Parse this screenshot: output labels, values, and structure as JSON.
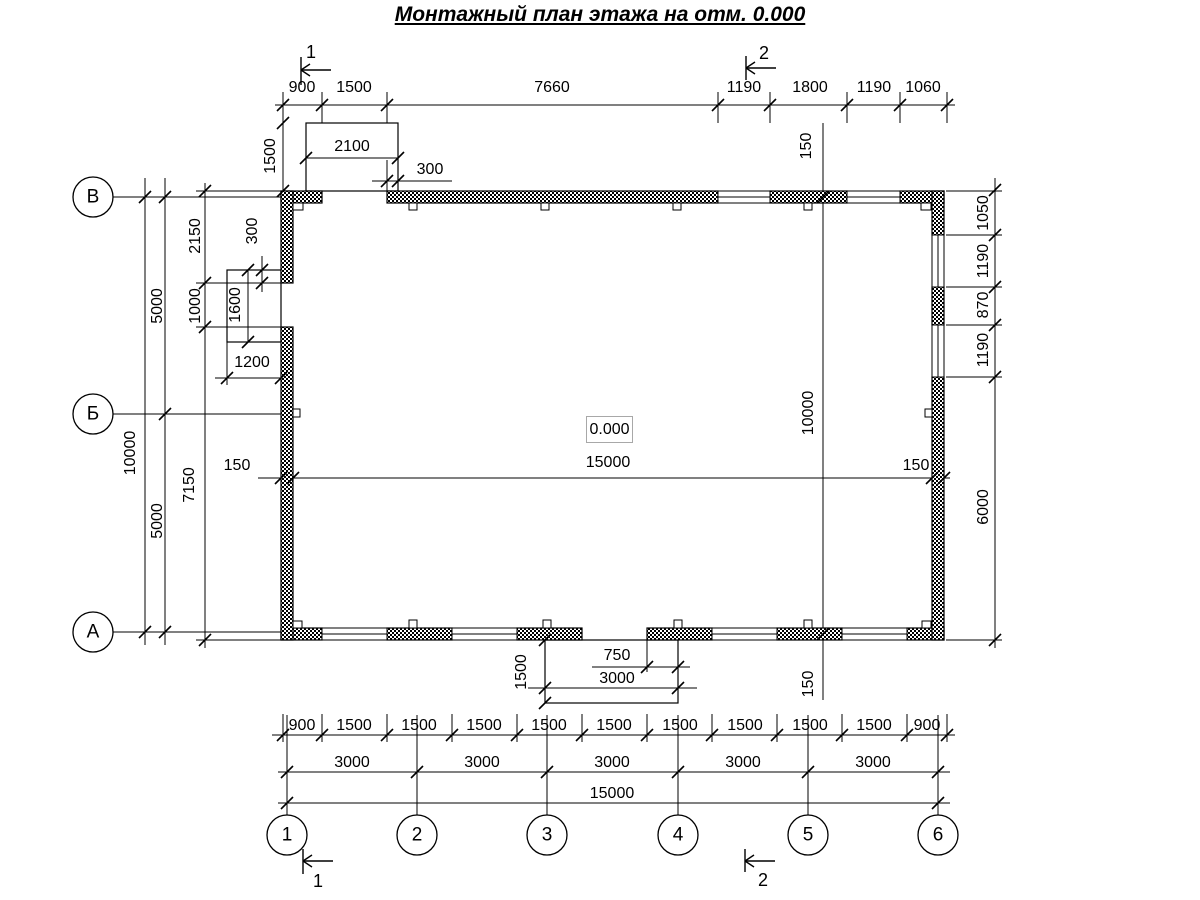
{
  "title": "Монтажный план этажа на отм. 0.000",
  "elevation_label": "0.000",
  "dim_labels": [
    {
      "t": "900",
      "x": 302,
      "y": 88
    },
    {
      "t": "1500",
      "x": 354,
      "y": 88
    },
    {
      "t": "7660",
      "x": 552,
      "y": 88
    },
    {
      "t": "1190",
      "x": 744,
      "y": 88
    },
    {
      "t": "1800",
      "x": 810,
      "y": 88
    },
    {
      "t": "1190",
      "x": 874,
      "y": 88
    },
    {
      "t": "1060",
      "x": 923,
      "y": 88
    },
    {
      "t": "2100",
      "x": 352,
      "y": 147
    },
    {
      "t": "1500",
      "x": 271,
      "y": 156,
      "r": 1
    },
    {
      "t": "300",
      "x": 430,
      "y": 170
    },
    {
      "t": "150",
      "x": 807,
      "y": 146,
      "r": 1
    },
    {
      "t": "300",
      "x": 253,
      "y": 231,
      "r": 1
    },
    {
      "t": "2150",
      "x": 196,
      "y": 236,
      "r": 1
    },
    {
      "t": "1000",
      "x": 196,
      "y": 306,
      "r": 1
    },
    {
      "t": "1600",
      "x": 236,
      "y": 305,
      "r": 1
    },
    {
      "t": "1200",
      "x": 252,
      "y": 363
    },
    {
      "t": "5000",
      "x": 158,
      "y": 306,
      "r": 1
    },
    {
      "t": "5000",
      "x": 158,
      "y": 521,
      "r": 1
    },
    {
      "t": "10000",
      "x": 131,
      "y": 453,
      "r": 1
    },
    {
      "t": "7150",
      "x": 190,
      "y": 485,
      "r": 1
    },
    {
      "t": "1050",
      "x": 984,
      "y": 213,
      "r": 1
    },
    {
      "t": "1190",
      "x": 984,
      "y": 261,
      "r": 1
    },
    {
      "t": "870",
      "x": 984,
      "y": 305,
      "r": 1
    },
    {
      "t": "1190",
      "x": 984,
      "y": 350,
      "r": 1
    },
    {
      "t": "6000",
      "x": 984,
      "y": 507,
      "r": 1
    },
    {
      "t": "10000",
      "x": 809,
      "y": 413,
      "r": 1
    },
    {
      "t": "150",
      "x": 237,
      "y": 466
    },
    {
      "t": "15000",
      "x": 608,
      "y": 463
    },
    {
      "t": "150",
      "x": 916,
      "y": 466
    },
    {
      "t": "1500",
      "x": 522,
      "y": 672,
      "r": 1
    },
    {
      "t": "750",
      "x": 617,
      "y": 656
    },
    {
      "t": "3000",
      "x": 617,
      "y": 679
    },
    {
      "t": "150",
      "x": 809,
      "y": 684,
      "r": 1
    },
    {
      "t": "900",
      "x": 302,
      "y": 726
    },
    {
      "t": "1500",
      "x": 354,
      "y": 726
    },
    {
      "t": "1500",
      "x": 419,
      "y": 726
    },
    {
      "t": "1500",
      "x": 484,
      "y": 726
    },
    {
      "t": "1500",
      "x": 549,
      "y": 726
    },
    {
      "t": "1500",
      "x": 614,
      "y": 726
    },
    {
      "t": "1500",
      "x": 680,
      "y": 726
    },
    {
      "t": "1500",
      "x": 745,
      "y": 726
    },
    {
      "t": "1500",
      "x": 810,
      "y": 726
    },
    {
      "t": "1500",
      "x": 874,
      "y": 726
    },
    {
      "t": "900",
      "x": 927,
      "y": 726
    },
    {
      "t": "3000",
      "x": 352,
      "y": 763
    },
    {
      "t": "3000",
      "x": 482,
      "y": 763
    },
    {
      "t": "3000",
      "x": 612,
      "y": 763
    },
    {
      "t": "3000",
      "x": 743,
      "y": 763
    },
    {
      "t": "3000",
      "x": 873,
      "y": 763
    },
    {
      "t": "15000",
      "x": 612,
      "y": 794
    }
  ],
  "axis_labels": [
    {
      "t": "В",
      "x": 93,
      "y": 197
    },
    {
      "t": "Б",
      "x": 93,
      "y": 414
    },
    {
      "t": "А",
      "x": 93,
      "y": 632
    },
    {
      "t": "1",
      "x": 287,
      "y": 835
    },
    {
      "t": "2",
      "x": 417,
      "y": 835
    },
    {
      "t": "3",
      "x": 547,
      "y": 835
    },
    {
      "t": "4",
      "x": 678,
      "y": 835
    },
    {
      "t": "5",
      "x": 808,
      "y": 835
    },
    {
      "t": "6",
      "x": 938,
      "y": 835
    }
  ],
  "section_labels": [
    {
      "t": "1",
      "x": 311,
      "y": 52
    },
    {
      "t": "2",
      "x": 764,
      "y": 53
    },
    {
      "t": "1",
      "x": 318,
      "y": 881
    },
    {
      "t": "2",
      "x": 763,
      "y": 880
    }
  ]
}
